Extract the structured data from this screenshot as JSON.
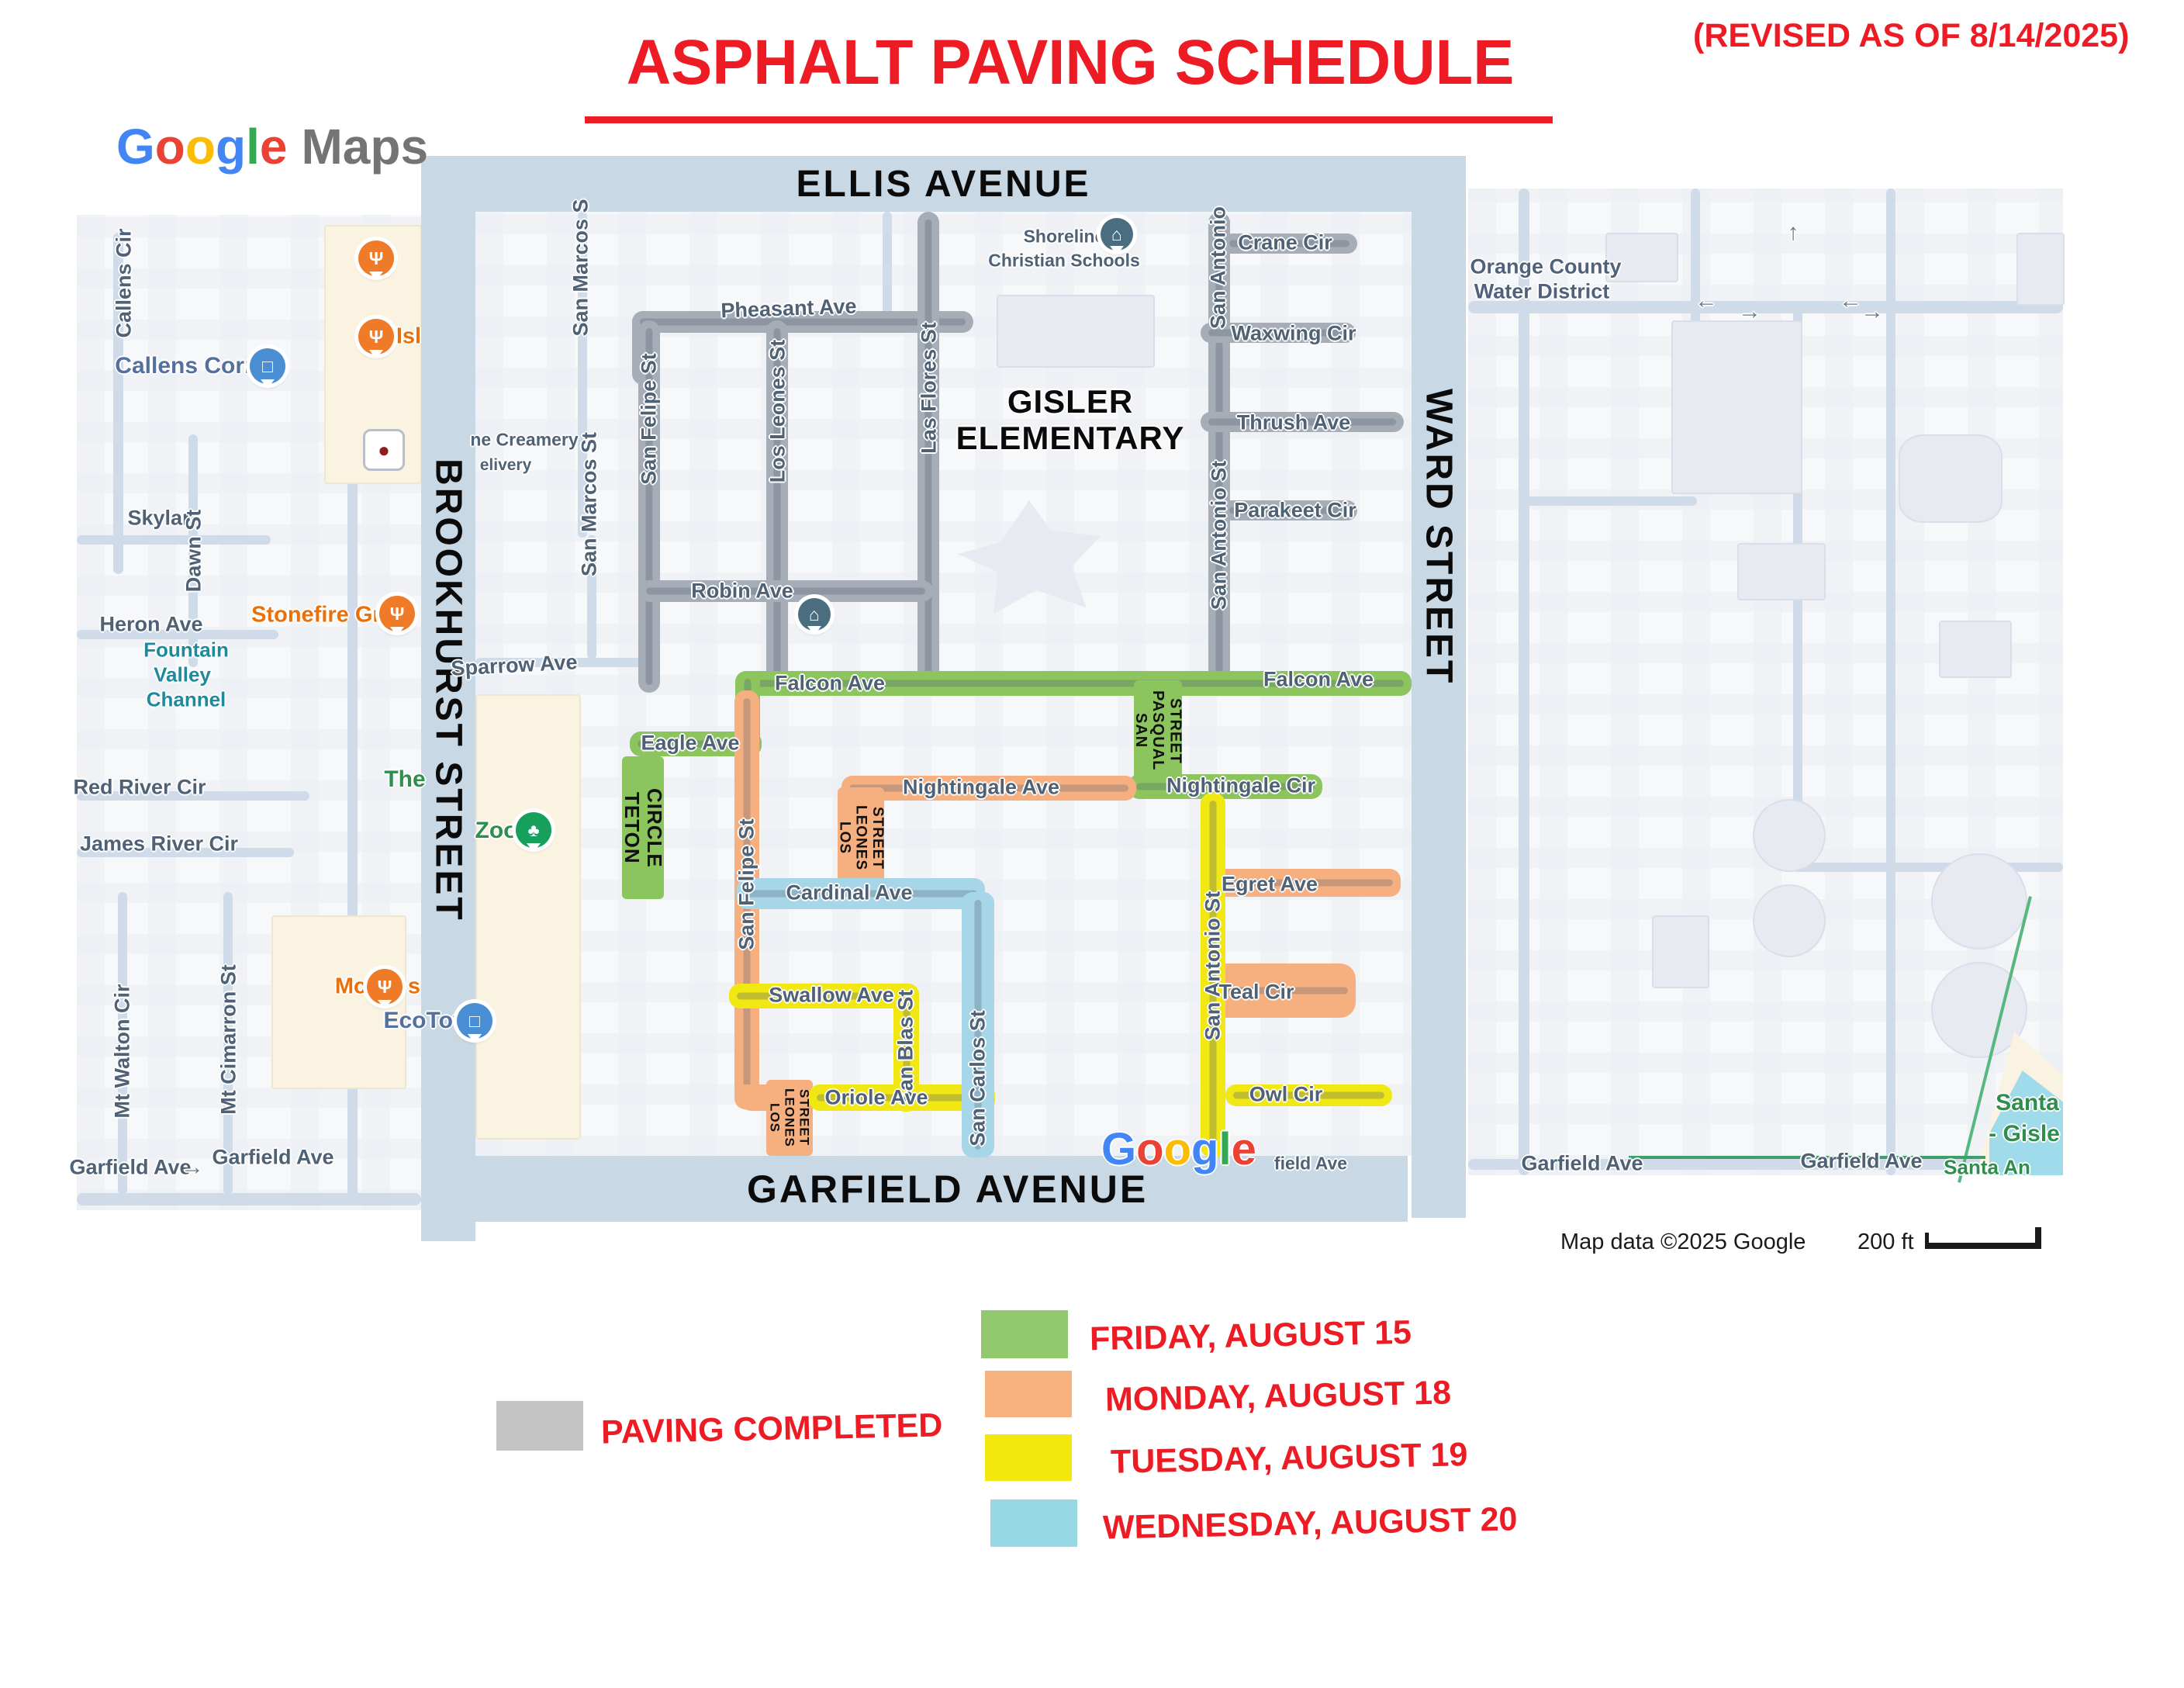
{
  "header": {
    "logo_letters": [
      "G",
      "o",
      "o",
      "g",
      "l",
      "e"
    ],
    "logo_suffix": "Maps",
    "title": "ASPHALT PAVING SCHEDULE",
    "revised": "(REVISED AS OF 8/14/2025)"
  },
  "boundary_streets": {
    "top": "ELLIS AVENUE",
    "bottom": "GARFIELD AVENUE",
    "left": "BROOKHURST STREET",
    "right": "WARD STREET"
  },
  "legend": {
    "completed": {
      "label": "PAVING COMPLETED",
      "color": "#c4c4c4"
    },
    "entries": [
      {
        "label": "FRIDAY, AUGUST 15",
        "color": "#92c96e"
      },
      {
        "label": "MONDAY, AUGUST 18",
        "color": "#f8b27e"
      },
      {
        "label": "TUESDAY, AUGUST 19",
        "color": "#f2e70e"
      },
      {
        "label": "WEDNESDAY, AUGUST 20",
        "color": "#96d9e4"
      }
    ]
  },
  "map": {
    "streets": {
      "pheasant": "Pheasant Ave",
      "san_marcos_top": "San Marcos S",
      "san_marcos_mid": "San Marcos St",
      "san_felipe_top": "San Felipe St",
      "los_leones_top": "Los Leones St",
      "las_flores": "Las Flores St",
      "san_antonio_top": "San Antonio",
      "crane": "Crane Cir",
      "waxwing": "Waxwing Cir",
      "thrush": "Thrush Ave",
      "san_antonio_mid": "San Antonio St",
      "parakeet": "Parakeet Cir",
      "robin": "Robin Ave",
      "sparrow": "Sparrow Ave",
      "falcon_w": "Falcon Ave",
      "falcon_e": "Falcon Ave",
      "eagle": "Eagle Ave",
      "teton_circle": "TETON CIRCLE",
      "san_pasqual": "SAN PASQUAL STREET",
      "nightingale_ave": "Nightingale Ave",
      "nightingale_cir": "Nightingale Cir",
      "los_leones_upper": "LOS LEONES STREET",
      "san_felipe_mid": "San Felipe St",
      "cardinal": "Cardinal Ave",
      "san_antonio_lower": "San Antonio St",
      "egret": "Egret Ave",
      "swallow": "Swallow Ave",
      "teal": "Teal Cir",
      "san_blas": "San Blas St",
      "san_carlos": "San Carlos St",
      "oriole": "Oriole Ave",
      "owl": "Owl Cir",
      "los_leones_lower": "LOS LEONES STREET"
    },
    "places": {
      "gisler_1": "GISLER",
      "gisler_2": "ELEMENTARY",
      "shoreline_1": "Shoreline",
      "shoreline_2": "Christian Schools",
      "creamery": "ne Creamery",
      "delivery": "elivery",
      "zoo": "Zoo",
      "the": "The",
      "callens_cir": "Callens Cir",
      "callens_corner": "Callens Corner",
      "isl": "Isl",
      "skylar": "Skylar",
      "dawn": "Dawn St",
      "heron": "Heron Ave",
      "channel_1": "Fountain",
      "channel_2": "Valley",
      "channel_3": "Channel",
      "stonefire": "Stonefire Grill",
      "red_river": "Red River Cir",
      "james_river": "James River Cir",
      "mt_walton": "Mt Walton Cir",
      "mt_cimarron": "Mt Cimarron St",
      "garfield_left_1": "Garfield Ave",
      "garfield_left_2": "Garfield Ave",
      "garfield_central": "field Ave",
      "mc_1": "Mc",
      "mc_2": "s",
      "ecotown": "EcoTown",
      "ocwd_1": "Orange County",
      "ocwd_2": "Water District",
      "garfield_right_1": "Garfield Ave",
      "garfield_right_2": "Garfield Ave",
      "santa_1": "Santa",
      "santa_2": "- Gisle",
      "santa_ana": "Santa An",
      "arrow_left": "←",
      "arrow_right": "→",
      "arrow_up": "↑"
    },
    "icons": {
      "restaurant": "Ψ",
      "shopping": "□",
      "zoo": "♣",
      "school": "⌂",
      "creamery": "●"
    },
    "attribution": {
      "map_data": "Map data ©2025 Google",
      "scale_label": "200 ft",
      "watermark_letters": [
        "G",
        "o",
        "o",
        "g",
        "l",
        "e"
      ]
    }
  }
}
